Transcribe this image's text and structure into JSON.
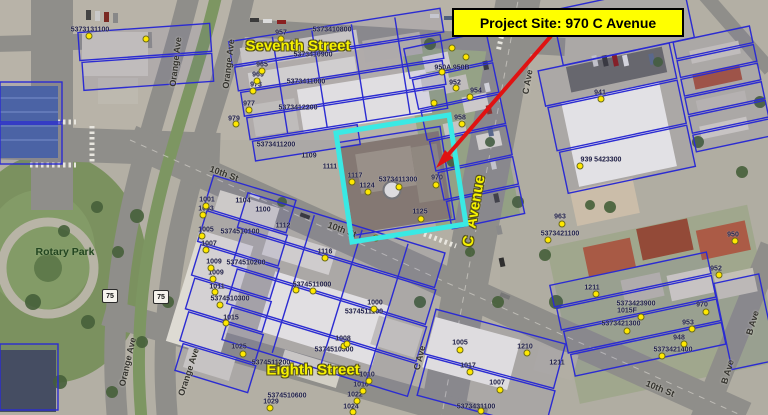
{
  "callout": {
    "label": "Project Site: 970 C Avenue"
  },
  "colors": {
    "callout_bg": "#ffff00",
    "callout_border": "#000000",
    "arrow": "#e01212",
    "site_highlight": "#3ae9e4",
    "parcel_line": "#2b2bd2",
    "street_label": "#f6f200",
    "road_label": "#34332e",
    "parcel_label": "#20204a"
  },
  "shields": [
    {
      "text": "75",
      "x": 110,
      "y": 296
    },
    {
      "text": "75",
      "x": 161,
      "y": 297
    }
  ],
  "annotations": [
    {
      "type": "street",
      "text": "Seventh Street",
      "x": 298,
      "y": 46,
      "rot": 0
    },
    {
      "type": "street",
      "text": "Eighth Street",
      "x": 313,
      "y": 370,
      "rot": 0
    },
    {
      "type": "street",
      "text": "C  Avenue",
      "x": 474,
      "y": 211,
      "rot": -80
    },
    {
      "type": "park",
      "text": "Rotary Park",
      "x": 65,
      "y": 252,
      "rot": 0
    },
    {
      "type": "road",
      "text": "10th St",
      "x": 224,
      "y": 174,
      "rot": 20
    },
    {
      "type": "road",
      "text": "10th St",
      "x": 342,
      "y": 230,
      "rot": 20
    },
    {
      "type": "road",
      "text": "10th St",
      "x": 660,
      "y": 389,
      "rot": 22
    },
    {
      "type": "road",
      "text": "C Ave",
      "x": 528,
      "y": 82,
      "rot": -80
    },
    {
      "type": "road",
      "text": "C Ave",
      "x": 420,
      "y": 358,
      "rot": -76
    },
    {
      "type": "road",
      "text": "B Ave",
      "x": 753,
      "y": 323,
      "rot": -73
    },
    {
      "type": "road",
      "text": "B Ave",
      "x": 728,
      "y": 372,
      "rot": -73
    },
    {
      "type": "road",
      "text": "Orange Ave",
      "x": 176,
      "y": 62,
      "rot": -83
    },
    {
      "type": "road",
      "text": "Orange Ave",
      "x": 229,
      "y": 64,
      "rot": -83
    },
    {
      "type": "road",
      "text": "Orange Ave",
      "x": 128,
      "y": 362,
      "rot": -77
    },
    {
      "type": "road",
      "text": "Orange Ave",
      "x": 189,
      "y": 372,
      "rot": -72
    },
    {
      "type": "parcel",
      "text": "5373131100",
      "x": 90,
      "y": 30,
      "rot": 0
    },
    {
      "type": "parcel",
      "text": "957",
      "x": 281,
      "y": 33,
      "rot": 0
    },
    {
      "type": "parcel",
      "text": "5373410800",
      "x": 332,
      "y": 30,
      "rot": 0
    },
    {
      "type": "parcel",
      "text": "965",
      "x": 262,
      "y": 65,
      "rot": 0
    },
    {
      "type": "parcel",
      "text": "5373410900",
      "x": 313,
      "y": 55,
      "rot": 0
    },
    {
      "type": "parcel",
      "text": "969",
      "x": 258,
      "y": 75,
      "rot": 0
    },
    {
      "type": "parcel",
      "text": "973",
      "x": 256,
      "y": 85,
      "rot": 0
    },
    {
      "type": "parcel",
      "text": "5373411000",
      "x": 306,
      "y": 82,
      "rot": 0
    },
    {
      "type": "parcel",
      "text": "977",
      "x": 249,
      "y": 104,
      "rot": 0
    },
    {
      "type": "parcel",
      "text": "5373412200",
      "x": 298,
      "y": 108,
      "rot": 0
    },
    {
      "type": "parcel",
      "text": "979",
      "x": 234,
      "y": 119,
      "rot": 0
    },
    {
      "type": "parcel",
      "text": "5373411200",
      "x": 276,
      "y": 145,
      "rot": 0
    },
    {
      "type": "parcel",
      "text": "1109",
      "x": 309,
      "y": 156,
      "rot": 0
    },
    {
      "type": "parcel",
      "text": "1111",
      "x": 330,
      "y": 167,
      "rot": 0
    },
    {
      "type": "parcel",
      "text": "1117",
      "x": 355,
      "y": 176,
      "rot": 0
    },
    {
      "type": "parcel",
      "text": "1124",
      "x": 367,
      "y": 186,
      "rot": 0
    },
    {
      "type": "parcel",
      "text": "5373411300",
      "x": 398,
      "y": 180,
      "rot": 0
    },
    {
      "type": "parcel",
      "text": "970",
      "x": 437,
      "y": 178,
      "rot": 0
    },
    {
      "type": "parcel",
      "text": "1125",
      "x": 420,
      "y": 212,
      "rot": 0
    },
    {
      "type": "parcel",
      "text": "1001",
      "x": 207,
      "y": 200,
      "rot": 0
    },
    {
      "type": "parcel",
      "text": "1003",
      "x": 206,
      "y": 209,
      "rot": 0
    },
    {
      "type": "parcel",
      "text": "1104",
      "x": 243,
      "y": 201,
      "rot": 0
    },
    {
      "type": "parcel",
      "text": "1100",
      "x": 263,
      "y": 210,
      "rot": 0
    },
    {
      "type": "parcel",
      "text": "1005",
      "x": 206,
      "y": 230,
      "rot": 0
    },
    {
      "type": "parcel",
      "text": "5374510100",
      "x": 240,
      "y": 232,
      "rot": 0
    },
    {
      "type": "parcel",
      "text": "1007",
      "x": 209,
      "y": 244,
      "rot": 0
    },
    {
      "type": "parcel",
      "text": "1009",
      "x": 214,
      "y": 262,
      "rot": 0
    },
    {
      "type": "parcel",
      "text": "5374510200",
      "x": 246,
      "y": 263,
      "rot": 0
    },
    {
      "type": "parcel",
      "text": "1009",
      "x": 216,
      "y": 273,
      "rot": 0
    },
    {
      "type": "parcel",
      "text": "1011",
      "x": 217,
      "y": 287,
      "rot": 0
    },
    {
      "type": "parcel",
      "text": "5374510300",
      "x": 230,
      "y": 299,
      "rot": 0
    },
    {
      "type": "parcel",
      "text": "1015",
      "x": 231,
      "y": 318,
      "rot": 0
    },
    {
      "type": "parcel",
      "text": "1025",
      "x": 239,
      "y": 347,
      "rot": 0
    },
    {
      "type": "parcel",
      "text": "5374511200",
      "x": 271,
      "y": 363,
      "rot": 0
    },
    {
      "type": "parcel",
      "text": "5374510600",
      "x": 287,
      "y": 396,
      "rot": 0
    },
    {
      "type": "parcel",
      "text": "1029",
      "x": 271,
      "y": 402,
      "rot": 0
    },
    {
      "type": "parcel",
      "text": "1112",
      "x": 283,
      "y": 226,
      "rot": 0
    },
    {
      "type": "parcel",
      "text": "1116",
      "x": 325,
      "y": 252,
      "rot": 0
    },
    {
      "type": "parcel",
      "text": "5374511000",
      "x": 312,
      "y": 285,
      "rot": 0
    },
    {
      "type": "parcel",
      "text": "1000",
      "x": 375,
      "y": 303,
      "rot": 0
    },
    {
      "type": "parcel",
      "text": "5374511100",
      "x": 364,
      "y": 312,
      "rot": 0
    },
    {
      "type": "parcel",
      "text": "1008",
      "x": 343,
      "y": 339,
      "rot": 0
    },
    {
      "type": "parcel",
      "text": "5374510500",
      "x": 334,
      "y": 350,
      "rot": 0
    },
    {
      "type": "parcel",
      "text": "1010",
      "x": 367,
      "y": 375,
      "rot": 0
    },
    {
      "type": "parcel",
      "text": "1016",
      "x": 361,
      "y": 385,
      "rot": 0
    },
    {
      "type": "parcel",
      "text": "1022",
      "x": 355,
      "y": 395,
      "rot": 0
    },
    {
      "type": "parcel",
      "text": "1024",
      "x": 351,
      "y": 407,
      "rot": 0
    },
    {
      "type": "parcel",
      "text": "1005",
      "x": 460,
      "y": 343,
      "rot": 0
    },
    {
      "type": "parcel",
      "text": "1017",
      "x": 468,
      "y": 366,
      "rot": 0
    },
    {
      "type": "parcel",
      "text": "1007",
      "x": 497,
      "y": 383,
      "rot": 0
    },
    {
      "type": "parcel",
      "text": "5373431100",
      "x": 476,
      "y": 407,
      "rot": 0
    },
    {
      "type": "parcel",
      "text": "1210",
      "x": 525,
      "y": 347,
      "rot": 0
    },
    {
      "type": "parcel",
      "text": "1211",
      "x": 557,
      "y": 363,
      "rot": 0
    },
    {
      "type": "parcel",
      "text": "950A 950B",
      "x": 452,
      "y": 68,
      "rot": 0
    },
    {
      "type": "parcel",
      "text": "952",
      "x": 455,
      "y": 83,
      "rot": 0
    },
    {
      "type": "parcel",
      "text": "954",
      "x": 476,
      "y": 91,
      "rot": 0
    },
    {
      "type": "parcel",
      "text": "958",
      "x": 460,
      "y": 118,
      "rot": 0
    },
    {
      "type": "parcel",
      "text": "941",
      "x": 600,
      "y": 93,
      "rot": 0
    },
    {
      "type": "parcel",
      "text": "939 5423300",
      "x": 601,
      "y": 160,
      "rot": 0
    },
    {
      "type": "parcel",
      "text": "963",
      "x": 560,
      "y": 217,
      "rot": 0
    },
    {
      "type": "parcel",
      "text": "5373421100",
      "x": 560,
      "y": 234,
      "rot": 0
    },
    {
      "type": "parcel",
      "text": "1211",
      "x": 592,
      "y": 288,
      "rot": 0
    },
    {
      "type": "parcel",
      "text": "950",
      "x": 733,
      "y": 235,
      "rot": 0
    },
    {
      "type": "parcel",
      "text": "952",
      "x": 716,
      "y": 269,
      "rot": 0
    },
    {
      "type": "parcel",
      "text": "5373423900",
      "x": 636,
      "y": 304,
      "rot": 0
    },
    {
      "type": "parcel",
      "text": "1015F",
      "x": 627,
      "y": 311,
      "rot": 0
    },
    {
      "type": "parcel",
      "text": "5373421300",
      "x": 621,
      "y": 324,
      "rot": 0
    },
    {
      "type": "parcel",
      "text": "970",
      "x": 702,
      "y": 305,
      "rot": 0
    },
    {
      "type": "parcel",
      "text": "953",
      "x": 688,
      "y": 323,
      "rot": 0
    },
    {
      "type": "parcel",
      "text": "948",
      "x": 679,
      "y": 338,
      "rot": 0
    },
    {
      "type": "parcel",
      "text": "5373421400",
      "x": 673,
      "y": 350,
      "rot": 0
    }
  ],
  "dots": [
    [
      281,
      39
    ],
    [
      262,
      71
    ],
    [
      257,
      81
    ],
    [
      253,
      91
    ],
    [
      249,
      110
    ],
    [
      236,
      124
    ],
    [
      206,
      206
    ],
    [
      203,
      215
    ],
    [
      202,
      236
    ],
    [
      206,
      250
    ],
    [
      211,
      268
    ],
    [
      213,
      279
    ],
    [
      215,
      292
    ],
    [
      220,
      305
    ],
    [
      226,
      323
    ],
    [
      243,
      354
    ],
    [
      270,
      408
    ],
    [
      296,
      290
    ],
    [
      344,
      346
    ],
    [
      369,
      381
    ],
    [
      363,
      391
    ],
    [
      357,
      401
    ],
    [
      353,
      412
    ],
    [
      460,
      350
    ],
    [
      470,
      372
    ],
    [
      500,
      390
    ],
    [
      481,
      411
    ],
    [
      527,
      353
    ],
    [
      452,
      48
    ],
    [
      466,
      57
    ],
    [
      442,
      72
    ],
    [
      456,
      88
    ],
    [
      470,
      97
    ],
    [
      434,
      103
    ],
    [
      462,
      124
    ],
    [
      601,
      99
    ],
    [
      580,
      166
    ],
    [
      562,
      224
    ],
    [
      548,
      240
    ],
    [
      735,
      241
    ],
    [
      719,
      275
    ],
    [
      641,
      317
    ],
    [
      627,
      331
    ],
    [
      692,
      329
    ],
    [
      706,
      312
    ],
    [
      684,
      344
    ],
    [
      662,
      356
    ],
    [
      596,
      294
    ],
    [
      352,
      182
    ],
    [
      368,
      192
    ],
    [
      399,
      187
    ],
    [
      436,
      185
    ],
    [
      421,
      219
    ],
    [
      376,
      238
    ],
    [
      325,
      258
    ],
    [
      313,
      291
    ],
    [
      374,
      309
    ],
    [
      347,
      344
    ],
    [
      146,
      39
    ],
    [
      89,
      36
    ]
  ]
}
